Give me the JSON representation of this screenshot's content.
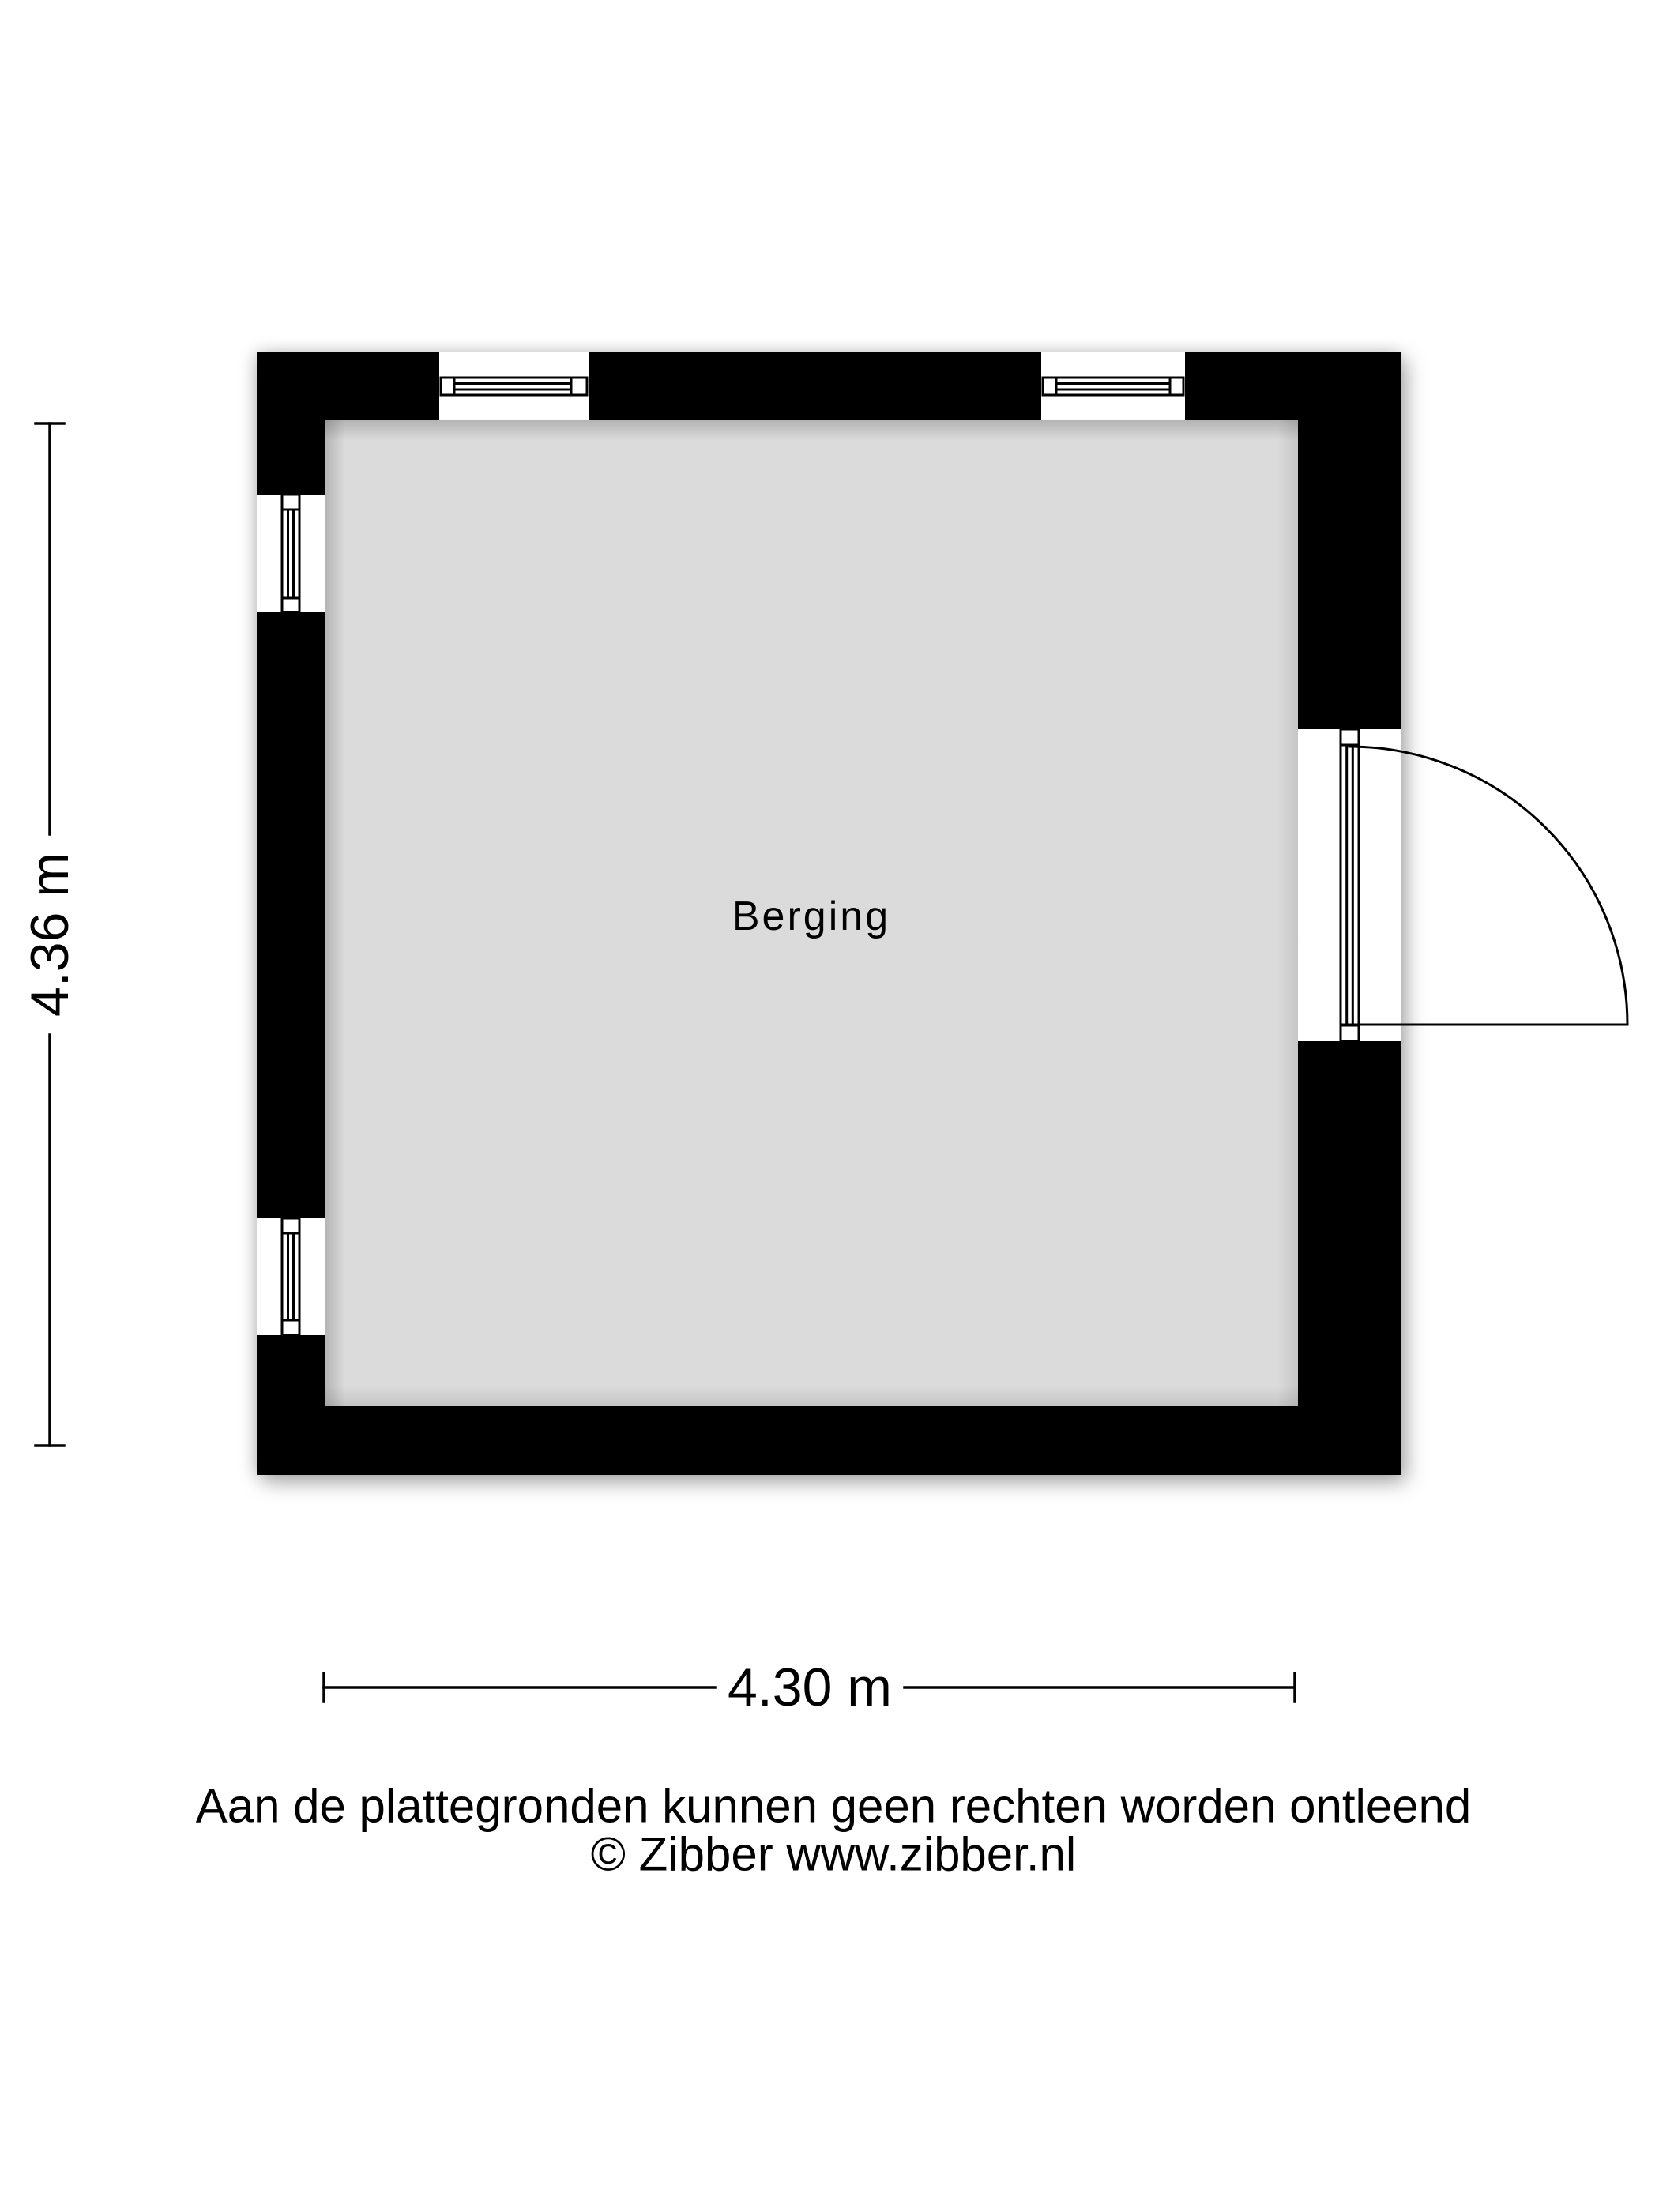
{
  "floorplan": {
    "room": {
      "label": "Berging"
    },
    "dimensions": {
      "height": "4.36 m",
      "width": "4.30 m"
    },
    "footer": {
      "disclaimer": "Aan de plattegronden kunnen geen rechten worden ontleend",
      "copyright": "© Zibber www.zibber.nl"
    },
    "colors": {
      "background": "#ffffff",
      "wall": "#000000",
      "floor": "#dbdbdb",
      "line": "#000000",
      "text": "#000000"
    }
  }
}
